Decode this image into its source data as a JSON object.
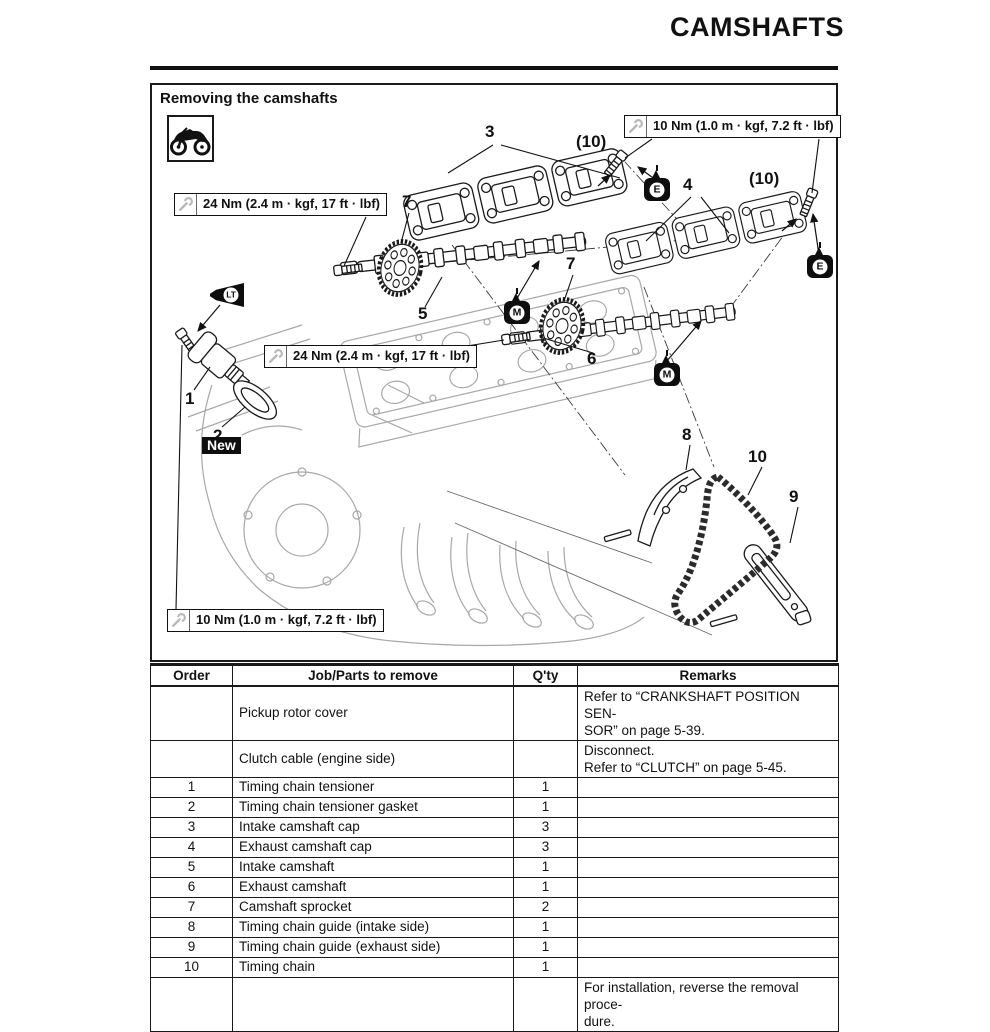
{
  "page": {
    "title": "CAMSHAFTS"
  },
  "diagram": {
    "heading": "Removing the camshafts",
    "torque_boxes": [
      {
        "id": "top-right",
        "text": "10 Nm (1.0 m · kgf, 7.2 ft · lbf)"
      },
      {
        "id": "upper-left",
        "text": "24 Nm (2.4 m · kgf, 17 ft · lbf)"
      },
      {
        "id": "middle",
        "text": "24 Nm (2.4 m · kgf, 17 ft · lbf)"
      },
      {
        "id": "bottom-left",
        "text": "10 Nm (1.0 m · kgf, 7.2 ft · lbf)"
      }
    ],
    "callouts": {
      "n1": "1",
      "n2": "2",
      "n3": "3",
      "n4": "4",
      "n5": "5",
      "n6": "6",
      "n7a": "7",
      "n7b": "7",
      "n8": "8",
      "n9": "9",
      "n10": "10",
      "bolt_a": "(10)",
      "bolt_b": "(10)"
    },
    "tags": {
      "new_label": "New"
    },
    "symbols": {
      "engine_oil": "E",
      "molybdenum_grease": "M",
      "locking_agent": "LT"
    }
  },
  "table": {
    "headers": [
      "Order",
      "Job/Parts to remove",
      "Q'ty",
      "Remarks"
    ],
    "rows": [
      {
        "order": "",
        "job": "Pickup rotor cover",
        "qty": "",
        "remarks": "Refer to “CRANKSHAFT POSITION SEN-\nSOR” on page 5-39."
      },
      {
        "order": "",
        "job": "Clutch cable (engine side)",
        "qty": "",
        "remarks": "Disconnect.\nRefer to “CLUTCH” on page 5-45."
      },
      {
        "order": "1",
        "job": "Timing chain tensioner",
        "qty": "1",
        "remarks": ""
      },
      {
        "order": "2",
        "job": "Timing chain tensioner gasket",
        "qty": "1",
        "remarks": ""
      },
      {
        "order": "3",
        "job": "Intake camshaft cap",
        "qty": "3",
        "remarks": ""
      },
      {
        "order": "4",
        "job": "Exhaust camshaft cap",
        "qty": "3",
        "remarks": ""
      },
      {
        "order": "5",
        "job": "Intake camshaft",
        "qty": "1",
        "remarks": ""
      },
      {
        "order": "6",
        "job": "Exhaust camshaft",
        "qty": "1",
        "remarks": ""
      },
      {
        "order": "7",
        "job": "Camshaft sprocket",
        "qty": "2",
        "remarks": ""
      },
      {
        "order": "8",
        "job": "Timing chain guide (intake side)",
        "qty": "1",
        "remarks": ""
      },
      {
        "order": "9",
        "job": "Timing chain guide (exhaust side)",
        "qty": "1",
        "remarks": ""
      },
      {
        "order": "10",
        "job": "Timing chain",
        "qty": "1",
        "remarks": ""
      },
      {
        "order": "",
        "job": "",
        "qty": "",
        "remarks": "For installation, reverse the removal proce-\ndure."
      }
    ]
  }
}
